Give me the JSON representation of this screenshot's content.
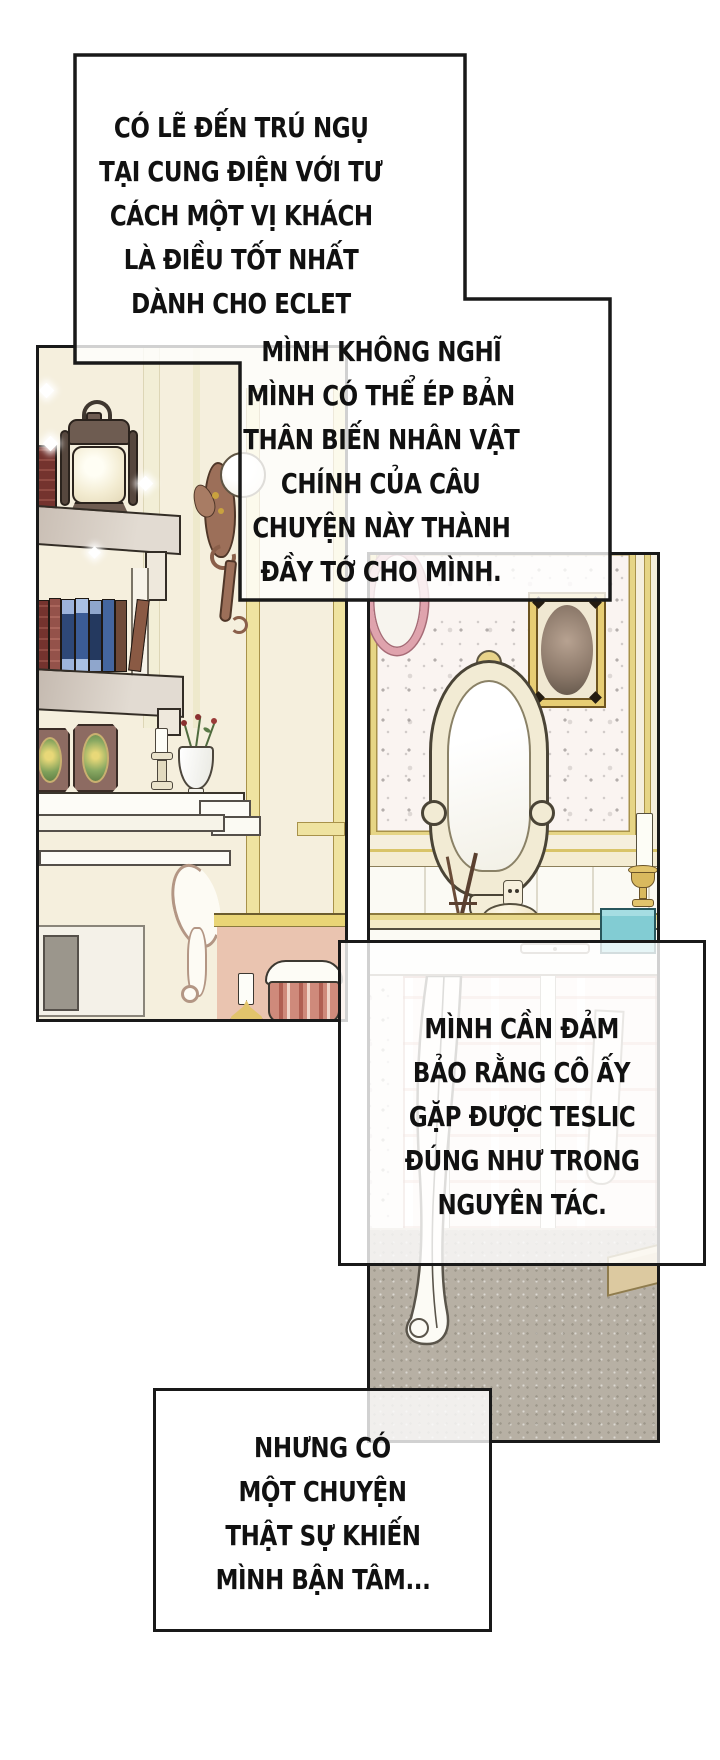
{
  "page_title": "manhwa-page",
  "captions": {
    "box1": {
      "lines": [
        "CÓ LẼ ĐẾN TRÚ NGỤ",
        "TẠI CUNG ĐIỆN VỚI TƯ",
        "CÁCH MỘT VỊ KHÁCH",
        "LÀ ĐIỀU TỐT NHẤT",
        "DÀNH CHO ECLET"
      ]
    },
    "box2": {
      "lines": [
        "MÌNH KHÔNG NGHĨ",
        "MÌNH CÓ THỂ ÉP BẢN",
        "THÂN BIẾN NHÂN VẬT",
        "CHÍNH CỦA CÂU",
        "CHUYỆN NÀY THÀNH",
        "ĐẦY TỚ CHO MÌNH."
      ]
    },
    "box3": {
      "lines": [
        "MÌNH CẦN ĐẢM",
        "BẢO RẰNG CÔ ẤY",
        "GẶP ĐƯỢC TESLIC",
        "ĐÚNG NHƯ TRONG",
        "NGUYÊN TÁC."
      ]
    },
    "box4": {
      "lines": [
        "NHƯNG CÓ",
        "MỘT CHUYỆN",
        "THẬT SỰ KHIẾN",
        "MÌNH BẬN TÂM..."
      ]
    }
  },
  "colors": {
    "ink": "#191919",
    "page": "#ffffff",
    "cream": "#f5efdd",
    "gold": "#e8d584",
    "goldline": "#a8924a",
    "pink": "#eac4b0",
    "wallpaper": "#faf4f1",
    "floor": "#b7b0a4",
    "navy": "#2e4878",
    "maroon": "#74332e",
    "stool": "#cf8a7b",
    "teal": "#82ccd3",
    "sconce": "#9c6f59",
    "framegold": "#e7cd74",
    "taupe": "#c9beb4",
    "glass": "#fdfdf8"
  }
}
